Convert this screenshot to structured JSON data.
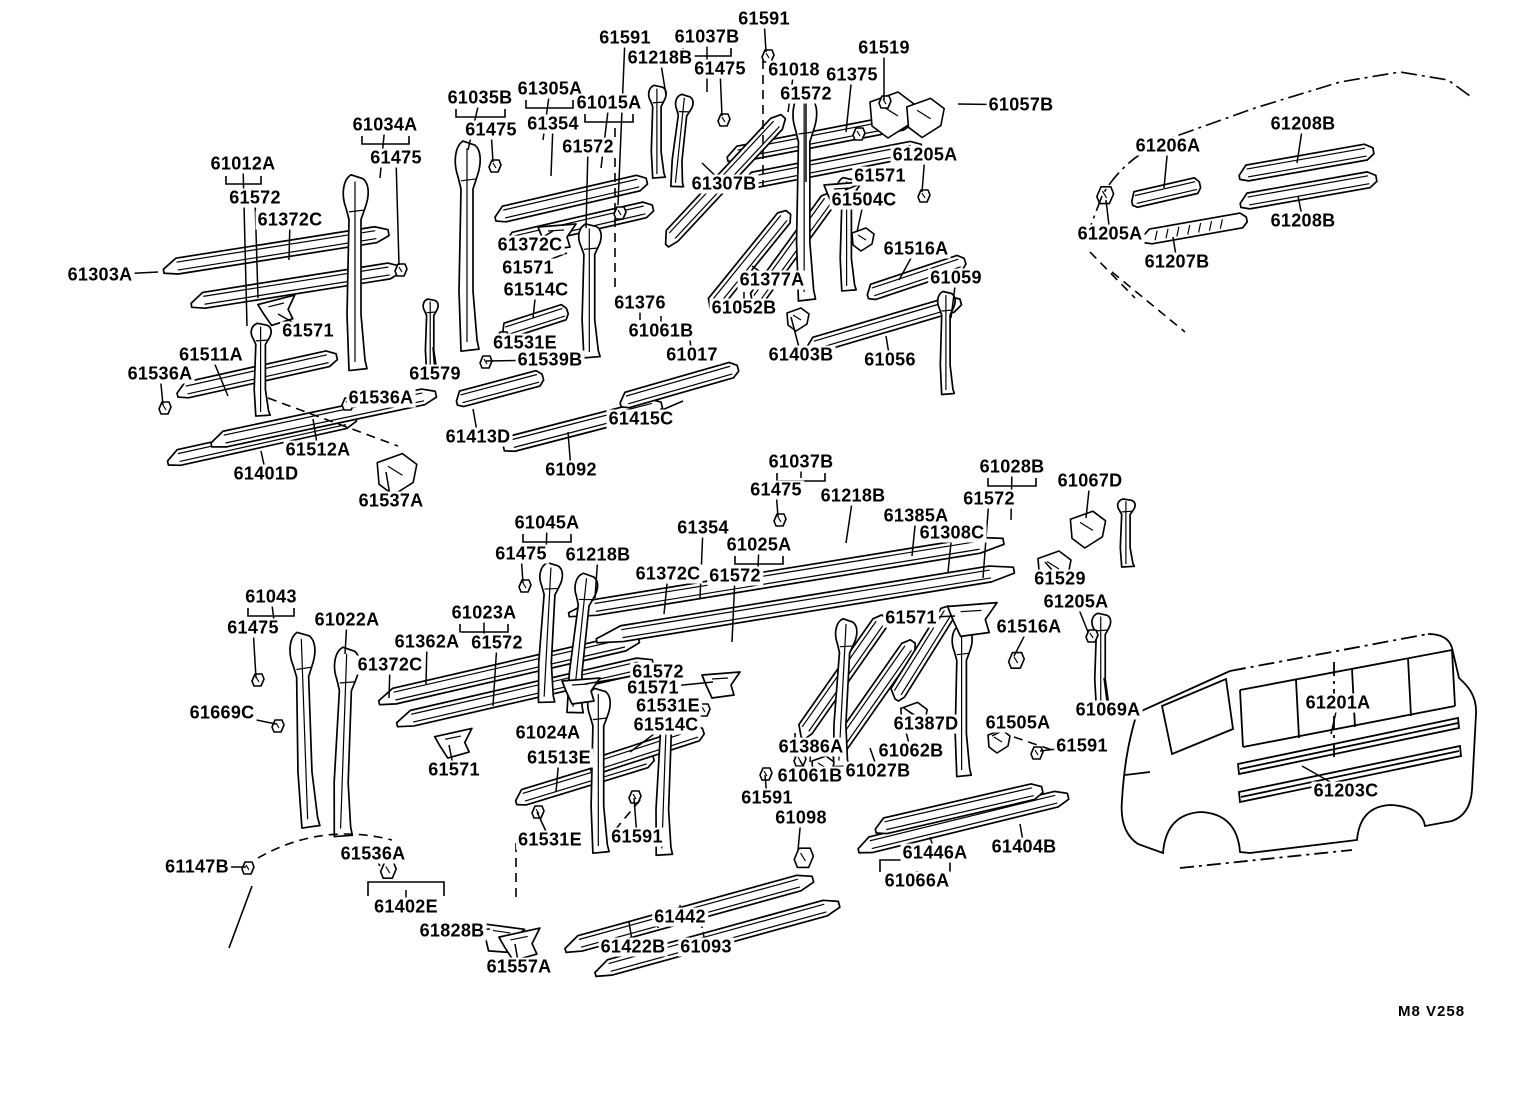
{
  "footer": {
    "code": "M8 V258"
  },
  "colors": {
    "background": "#ffffff",
    "ink": "#000000"
  },
  "diagram": {
    "kind": "exploded-parts-diagram",
    "part_number_prefix": "61"
  },
  "labels": [
    {
      "t": "61591",
      "x": 625,
      "y": 38,
      "lx": 618,
      "ly": 205
    },
    {
      "t": "61037B",
      "x": 707,
      "y": 37,
      "lx": 707,
      "ly": 92
    },
    {
      "t": "61591",
      "x": 764,
      "y": 19,
      "lx": 766,
      "ly": 52
    },
    {
      "t": "61218B",
      "x": 660,
      "y": 58,
      "lx": 666,
      "ly": 95
    },
    {
      "t": "61475",
      "x": 720,
      "y": 69,
      "lx": 722,
      "ly": 116
    },
    {
      "t": "61018",
      "x": 794,
      "y": 70,
      "lx": 788,
      "ly": 112
    },
    {
      "t": "61375",
      "x": 852,
      "y": 75,
      "lx": 846,
      "ly": 132
    },
    {
      "t": "61519",
      "x": 884,
      "y": 48,
      "lx": 884,
      "ly": 100
    },
    {
      "t": "61572",
      "x": 806,
      "y": 94,
      "lx": 806,
      "ly": 182
    },
    {
      "t": "61057B",
      "x": 1021,
      "y": 105,
      "lx": 958,
      "ly": 104
    },
    {
      "t": "61035B",
      "x": 480,
      "y": 98,
      "lx": 468,
      "ly": 150
    },
    {
      "t": "61305A",
      "x": 550,
      "y": 89,
      "lx": 543,
      "ly": 140
    },
    {
      "t": "61015A",
      "x": 609,
      "y": 103,
      "lx": 601,
      "ly": 168
    },
    {
      "t": "61475",
      "x": 491,
      "y": 130,
      "lx": 493,
      "ly": 162
    },
    {
      "t": "61354",
      "x": 553,
      "y": 124,
      "lx": 551,
      "ly": 176
    },
    {
      "t": "61572",
      "x": 588,
      "y": 147,
      "lx": 586,
      "ly": 228
    },
    {
      "t": "61034A",
      "x": 385,
      "y": 125,
      "lx": 380,
      "ly": 178
    },
    {
      "t": "61475",
      "x": 396,
      "y": 158,
      "lx": 399,
      "ly": 265
    },
    {
      "t": "61012A",
      "x": 243,
      "y": 164,
      "lx": 247,
      "ly": 326
    },
    {
      "t": "61572",
      "x": 255,
      "y": 198,
      "lx": 258,
      "ly": 298
    },
    {
      "t": "61372C",
      "x": 290,
      "y": 220,
      "lx": 289,
      "ly": 260
    },
    {
      "t": "61205A",
      "x": 925,
      "y": 155,
      "lx": 922,
      "ly": 192
    },
    {
      "t": "61571",
      "x": 880,
      "y": 176,
      "lx": 845,
      "ly": 190
    },
    {
      "t": "61504C",
      "x": 864,
      "y": 200,
      "lx": 857,
      "ly": 232
    },
    {
      "t": "61307B",
      "x": 724,
      "y": 184,
      "lx": 702,
      "ly": 163
    },
    {
      "t": "61372C",
      "x": 530,
      "y": 245,
      "lx": 553,
      "ly": 231
    },
    {
      "t": "61571",
      "x": 528,
      "y": 268,
      "lx": 567,
      "ly": 253
    },
    {
      "t": "61514C",
      "x": 536,
      "y": 290,
      "lx": 533,
      "ly": 318
    },
    {
      "t": "61516A",
      "x": 916,
      "y": 249,
      "lx": 899,
      "ly": 280
    },
    {
      "t": "61059",
      "x": 956,
      "y": 278,
      "lx": 951,
      "ly": 318
    },
    {
      "t": "61303A",
      "x": 100,
      "y": 275,
      "lx": 158,
      "ly": 272
    },
    {
      "t": "61571",
      "x": 308,
      "y": 331,
      "lx": 278,
      "ly": 314
    },
    {
      "t": "61376",
      "x": 640,
      "y": 303,
      "lx": 640,
      "ly": 320
    },
    {
      "t": "61377A",
      "x": 772,
      "y": 280,
      "lx": 752,
      "ly": 266
    },
    {
      "t": "61052B",
      "x": 744,
      "y": 308,
      "lx": 744,
      "ly": 292
    },
    {
      "t": "61511A",
      "x": 211,
      "y": 355,
      "lx": 228,
      "ly": 396
    },
    {
      "t": "61531E",
      "x": 525,
      "y": 343,
      "lx": 502,
      "ly": 336
    },
    {
      "t": "61536A",
      "x": 160,
      "y": 374,
      "lx": 163,
      "ly": 405
    },
    {
      "t": "61539B",
      "x": 550,
      "y": 360,
      "lx": 486,
      "ly": 361
    },
    {
      "t": "61061B",
      "x": 661,
      "y": 331,
      "lx": 661,
      "ly": 316
    },
    {
      "t": "61017",
      "x": 692,
      "y": 355,
      "lx": 689,
      "ly": 333
    },
    {
      "t": "61403B",
      "x": 801,
      "y": 355,
      "lx": 791,
      "ly": 317
    },
    {
      "t": "61056",
      "x": 890,
      "y": 360,
      "lx": 886,
      "ly": 336
    },
    {
      "t": "61579",
      "x": 435,
      "y": 374,
      "lx": 433,
      "ly": 347
    },
    {
      "t": "61536A",
      "x": 381,
      "y": 398,
      "lx": 347,
      "ly": 403
    },
    {
      "t": "61415C",
      "x": 641,
      "y": 419,
      "lx": 683,
      "ly": 401
    },
    {
      "t": "61512A",
      "x": 318,
      "y": 450,
      "lx": 313,
      "ly": 419
    },
    {
      "t": "61401D",
      "x": 266,
      "y": 474,
      "lx": 261,
      "ly": 451
    },
    {
      "t": "61413D",
      "x": 478,
      "y": 437,
      "lx": 473,
      "ly": 409
    },
    {
      "t": "61092",
      "x": 571,
      "y": 470,
      "lx": 568,
      "ly": 432
    },
    {
      "t": "61537A",
      "x": 391,
      "y": 501,
      "lx": 386,
      "ly": 472
    },
    {
      "t": "61206A",
      "x": 1168,
      "y": 146,
      "lx": 1164,
      "ly": 188
    },
    {
      "t": "61208B",
      "x": 1303,
      "y": 124,
      "lx": 1297,
      "ly": 163
    },
    {
      "t": "61205A",
      "x": 1110,
      "y": 234,
      "lx": 1106,
      "ly": 200
    },
    {
      "t": "61208B",
      "x": 1303,
      "y": 221,
      "lx": 1298,
      "ly": 196
    },
    {
      "t": "61207B",
      "x": 1177,
      "y": 262,
      "lx": 1173,
      "ly": 237
    },
    {
      "t": "61037B",
      "x": 801,
      "y": 462,
      "lx": 801,
      "ly": 478
    },
    {
      "t": "61028B",
      "x": 1012,
      "y": 467,
      "lx": 1011,
      "ly": 520
    },
    {
      "t": "61067D",
      "x": 1090,
      "y": 481,
      "lx": 1086,
      "ly": 518
    },
    {
      "t": "61475",
      "x": 776,
      "y": 490,
      "lx": 778,
      "ly": 517
    },
    {
      "t": "61218B",
      "x": 853,
      "y": 496,
      "lx": 846,
      "ly": 543
    },
    {
      "t": "61572",
      "x": 989,
      "y": 499,
      "lx": 983,
      "ly": 578
    },
    {
      "t": "61385A",
      "x": 916,
      "y": 516,
      "lx": 912,
      "ly": 556
    },
    {
      "t": "61308C",
      "x": 952,
      "y": 533,
      "lx": 948,
      "ly": 572
    },
    {
      "t": "61045A",
      "x": 547,
      "y": 523,
      "lx": 546,
      "ly": 558
    },
    {
      "t": "61354",
      "x": 703,
      "y": 528,
      "lx": 700,
      "ly": 598
    },
    {
      "t": "61025A",
      "x": 759,
      "y": 545,
      "lx": 758,
      "ly": 568
    },
    {
      "t": "61475",
      "x": 521,
      "y": 554,
      "lx": 523,
      "ly": 583
    },
    {
      "t": "61218B",
      "x": 598,
      "y": 555,
      "lx": 595,
      "ly": 598
    },
    {
      "t": "61372C",
      "x": 668,
      "y": 574,
      "lx": 664,
      "ly": 614
    },
    {
      "t": "61572",
      "x": 735,
      "y": 576,
      "lx": 732,
      "ly": 642
    },
    {
      "t": "61529",
      "x": 1060,
      "y": 579,
      "lx": 1045,
      "ly": 562
    },
    {
      "t": "61571",
      "x": 911,
      "y": 618,
      "lx": 955,
      "ly": 616
    },
    {
      "t": "61205A",
      "x": 1076,
      "y": 602,
      "lx": 1088,
      "ly": 632
    },
    {
      "t": "61043",
      "x": 271,
      "y": 597,
      "lx": 276,
      "ly": 636
    },
    {
      "t": "61022A",
      "x": 347,
      "y": 620,
      "lx": 345,
      "ly": 654
    },
    {
      "t": "61516A",
      "x": 1029,
      "y": 627,
      "lx": 1014,
      "ly": 656
    },
    {
      "t": "61475",
      "x": 253,
      "y": 628,
      "lx": 256,
      "ly": 678
    },
    {
      "t": "61023A",
      "x": 484,
      "y": 613,
      "lx": 484,
      "ly": 642
    },
    {
      "t": "61362A",
      "x": 427,
      "y": 642,
      "lx": 426,
      "ly": 684
    },
    {
      "t": "61372C",
      "x": 390,
      "y": 665,
      "lx": 389,
      "ly": 698
    },
    {
      "t": "61572",
      "x": 497,
      "y": 643,
      "lx": 493,
      "ly": 706
    },
    {
      "t": "61572",
      "x": 658,
      "y": 672,
      "lx": 585,
      "ly": 684
    },
    {
      "t": "61571",
      "x": 653,
      "y": 688,
      "lx": 713,
      "ly": 682
    },
    {
      "t": "61669C",
      "x": 222,
      "y": 713,
      "lx": 276,
      "ly": 724
    },
    {
      "t": "61531E",
      "x": 668,
      "y": 706,
      "lx": 700,
      "ly": 710
    },
    {
      "t": "61514C",
      "x": 666,
      "y": 725,
      "lx": 630,
      "ly": 752
    },
    {
      "t": "61387D",
      "x": 926,
      "y": 724,
      "lx": 904,
      "ly": 708
    },
    {
      "t": "61505A",
      "x": 1018,
      "y": 723,
      "lx": 992,
      "ly": 736
    },
    {
      "t": "61069A",
      "x": 1108,
      "y": 710,
      "lx": 1104,
      "ly": 678
    },
    {
      "t": "61024A",
      "x": 548,
      "y": 733,
      "lx": 582,
      "ly": 734
    },
    {
      "t": "61062B",
      "x": 911,
      "y": 751,
      "lx": 906,
      "ly": 732
    },
    {
      "t": "61513E",
      "x": 559,
      "y": 758,
      "lx": 556,
      "ly": 792
    },
    {
      "t": "61386A",
      "x": 811,
      "y": 747,
      "lx": 810,
      "ly": 762
    },
    {
      "t": "61591",
      "x": 1082,
      "y": 746,
      "lx": 1040,
      "ly": 751
    },
    {
      "t": "61061B",
      "x": 810,
      "y": 776,
      "lx": 800,
      "ly": 761
    },
    {
      "t": "61027B",
      "x": 878,
      "y": 771,
      "lx": 870,
      "ly": 748
    },
    {
      "t": "61571",
      "x": 454,
      "y": 770,
      "lx": 449,
      "ly": 745
    },
    {
      "t": "61591",
      "x": 767,
      "y": 798,
      "lx": 765,
      "ly": 775
    },
    {
      "t": "61098",
      "x": 801,
      "y": 818,
      "lx": 798,
      "ly": 850
    },
    {
      "t": "61147B",
      "x": 197,
      "y": 867,
      "lx": 246,
      "ly": 867
    },
    {
      "t": "61536A",
      "x": 373,
      "y": 854,
      "lx": 380,
      "ly": 866
    },
    {
      "t": "61531E",
      "x": 550,
      "y": 840,
      "lx": 537,
      "ly": 812
    },
    {
      "t": "61591",
      "x": 637,
      "y": 837,
      "lx": 634,
      "ly": 798
    },
    {
      "t": "61402E",
      "x": 406,
      "y": 907,
      "lx": 406,
      "ly": 890
    },
    {
      "t": "61828B",
      "x": 452,
      "y": 931,
      "lx": 490,
      "ly": 929
    },
    {
      "t": "61557A",
      "x": 519,
      "y": 967,
      "lx": 515,
      "ly": 944
    },
    {
      "t": "61422B",
      "x": 633,
      "y": 947,
      "lx": 629,
      "ly": 922
    },
    {
      "t": "61093",
      "x": 706,
      "y": 947,
      "lx": 703,
      "ly": 932
    },
    {
      "t": "61442",
      "x": 680,
      "y": 917,
      "lx": 680,
      "ly": 905
    },
    {
      "t": "61446A",
      "x": 935,
      "y": 853,
      "lx": 930,
      "ly": 837
    },
    {
      "t": "61404B",
      "x": 1024,
      "y": 847,
      "lx": 1020,
      "ly": 824
    },
    {
      "t": "61066A",
      "x": 917,
      "y": 881,
      "lx": 917,
      "ly": 871
    },
    {
      "t": "61201A",
      "x": 1338,
      "y": 703,
      "lx": 1331,
      "ly": 734
    },
    {
      "t": "61203C",
      "x": 1346,
      "y": 791,
      "lx": 1302,
      "ly": 766
    }
  ]
}
